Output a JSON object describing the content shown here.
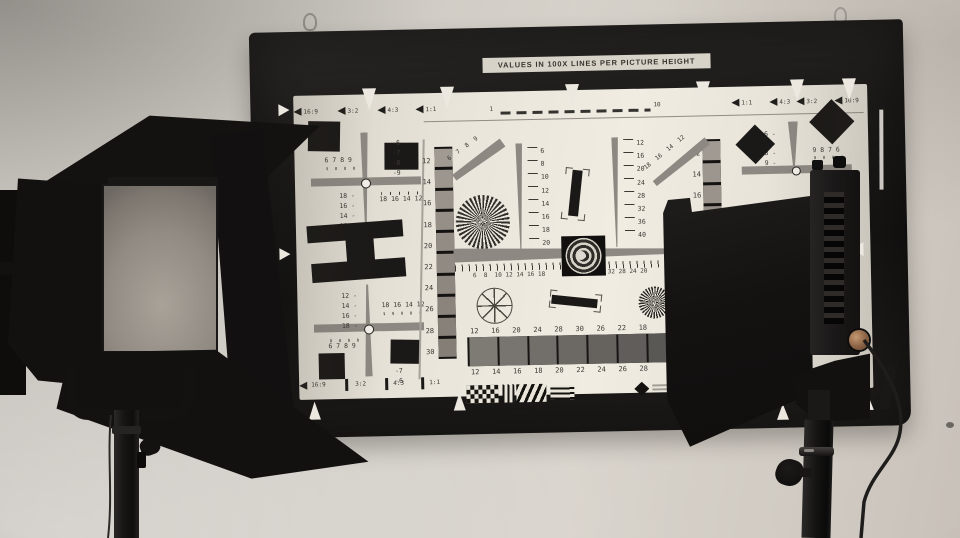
{
  "chart": {
    "header": "VALUES IN 100X LINES PER PICTURE HEIGHT",
    "ruler_start": "1",
    "ruler_end": "10",
    "aspect_tl": {
      "a": "16:9",
      "b": "3:2",
      "c": "4:3",
      "d": "1:1"
    },
    "aspect_tr": {
      "a": "1:1",
      "b": "4:3",
      "c": "3:2",
      "d": "16:9"
    },
    "aspect_bl": {
      "a": "16:9",
      "b": "3:2",
      "c": "4:3",
      "d": "1:1"
    },
    "cross_tl": {
      "top_numbers": "6 7 8 9",
      "right_column": "-6\n-7\n-8\n-9",
      "left_column": "18 -\n16 -\n14 -\n12 -",
      "bottom_numbers": "18 16 14 12"
    },
    "cross_bl": {
      "left_column": "12 -\n14 -\n16 -\n18 -",
      "top_numbers": "18 16 14 12",
      "bottom_numbers": "6 7 8 9",
      "right_column": "-9\n-8\n-7\n-6"
    },
    "cross_tr": {
      "left_column": "6 -\n7 -\n8 -\n9 -",
      "right_numbers": "9 8 7 6"
    },
    "left_scale": "12\n14\n16\n18\n20\n22\n24\n26\n28\n30",
    "right_scale": "12\n14\n16\n18\n20",
    "wedge_scale_a": "6\n8\n10\n12\n14\n16\n18\n20",
    "wedge_scale_b": "12\n16\n20\n24\n28\n32\n36\n40",
    "diag_scale_a": "6  7  8  9",
    "diag_scale_b": "18  16  14  12",
    "center_scale_left": "6  8  10 12 14 16 18",
    "center_scale_right": "36 32 28 24 20",
    "gray_top_labels": "12   16   20   24   28   30   26   22   18",
    "gray_bottom_labels": "12   14   16   18   20   22   24   26   28"
  },
  "colors": {
    "wall": "#d0ccc5",
    "frame": "#1c1b19",
    "paper": "#e9e5db",
    "panel_gray": "#948e85",
    "barn_door": "#131110",
    "brass_knob": "#8a6144"
  }
}
